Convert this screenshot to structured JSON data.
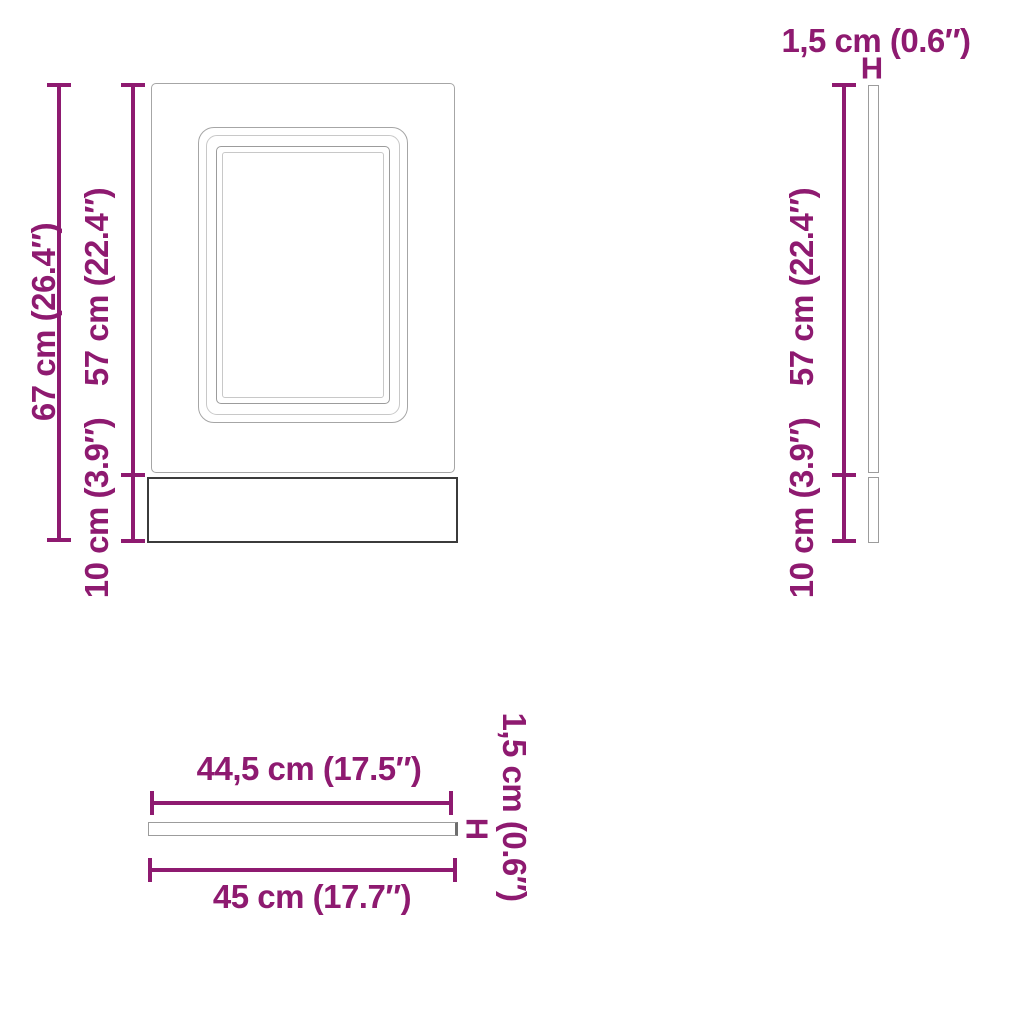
{
  "diagram": {
    "type": "furniture-dimension-diagram",
    "colors": {
      "accent": "#8e1a70",
      "outline_light": "#a6a6a6",
      "outline_lighter": "#c8c8c8",
      "outline_mid": "#9c9c9c",
      "outline_dark": "#3b3b3b"
    },
    "front_view": {
      "total_height_label": "67 cm (26.4″)",
      "door_height_label": "57 cm (22.4″)",
      "plinth_height_label": "10 cm (3.9″)"
    },
    "side_view": {
      "thickness_label": "1,5 cm (0.6″)",
      "thickness_marker": "H",
      "door_height_label": "57 cm (22.4″)",
      "plinth_height_label": "10 cm (3.9″)"
    },
    "top_view": {
      "inner_width_label": "44,5 cm (17.5″)",
      "total_width_label": "45 cm (17.7″)",
      "thickness_label": "1,5 cm (0.6″)",
      "thickness_marker": "H"
    }
  }
}
